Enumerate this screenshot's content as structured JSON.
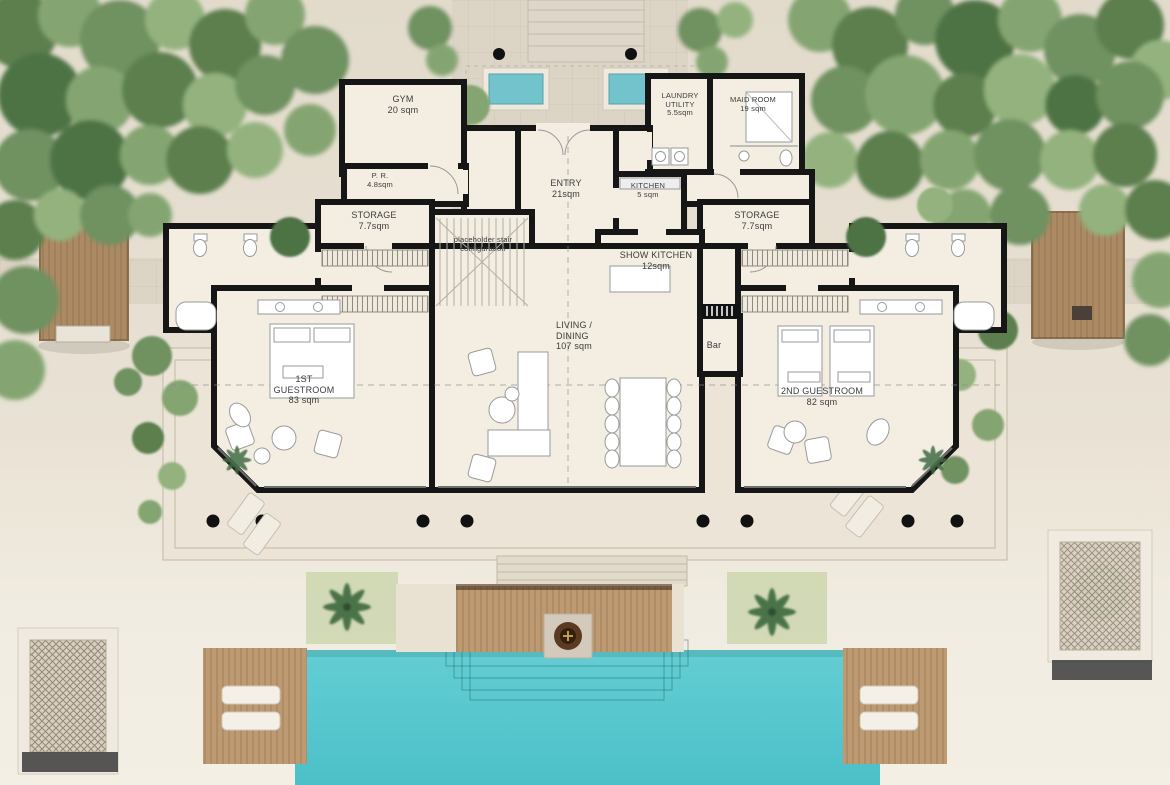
{
  "rooms": {
    "gym": {
      "lines": [
        "GYM",
        "20 sqm"
      ]
    },
    "pr": {
      "lines": [
        "P. R.",
        "4.8sqm"
      ]
    },
    "storage_left": {
      "lines": [
        "STORAGE",
        "7.7sqm"
      ]
    },
    "entry": {
      "lines": [
        "ENTRY",
        "21sqm"
      ]
    },
    "kitchen": {
      "lines": [
        "KITCHEN",
        "5 sqm"
      ]
    },
    "laundry": {
      "lines": [
        "LAUNDRY",
        "UTILITY",
        "5.5sqm"
      ]
    },
    "maid": {
      "lines": [
        "MAID ROOM",
        "19 sqm"
      ]
    },
    "storage_right": {
      "lines": [
        "STORAGE",
        "7.7sqm"
      ]
    },
    "stair": {
      "lines": [
        "placeholder stair",
        "configuration"
      ]
    },
    "show_kitchen": {
      "lines": [
        "SHOW KITCHEN",
        "12sqm"
      ]
    },
    "living": {
      "lines": [
        "LIVING /",
        "DINING",
        "107 sqm"
      ]
    },
    "bar": {
      "lines": [
        "Bar"
      ]
    },
    "guest1": {
      "lines": [
        "1ST",
        "GUESTROOM",
        "83 sqm"
      ]
    },
    "guest2": {
      "lines": [
        "2ND GUESTROOM",
        "82 sqm"
      ]
    }
  },
  "palette": {
    "sand": "#e7e0d2",
    "stone_path": "#dcd4c5",
    "terrace": "#ece5d7",
    "floor": "#f3ede2",
    "wall": "#161616",
    "pool_water": "#58c9cf",
    "wood_deck": "#bd9a72",
    "tree_canopy": "#6f9160",
    "grass": "#ccd6ae"
  }
}
